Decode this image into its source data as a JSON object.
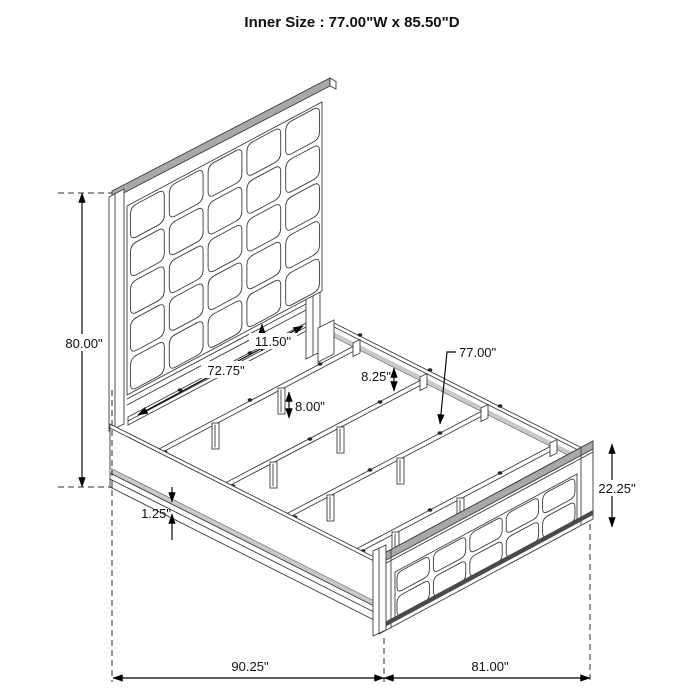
{
  "title": "Inner Size : 77.00\"W x 85.50\"D",
  "dims": {
    "headboard_height": "80.00\"",
    "head_inner_width": "72.75\"",
    "panel_to_rail_gap": "11.50\"",
    "center_leg_height": "8.00\"",
    "rail_to_slat_drop": "8.25\"",
    "slat_length": "77.00\"",
    "footboard_height": "22.25\"",
    "rail_lip": "1.25\"",
    "overall_depth": "90.25\"",
    "overall_width": "81.00\""
  },
  "colors": {
    "line": "#3d3d3d",
    "dimension": "#000000",
    "background": "#ffffff"
  }
}
